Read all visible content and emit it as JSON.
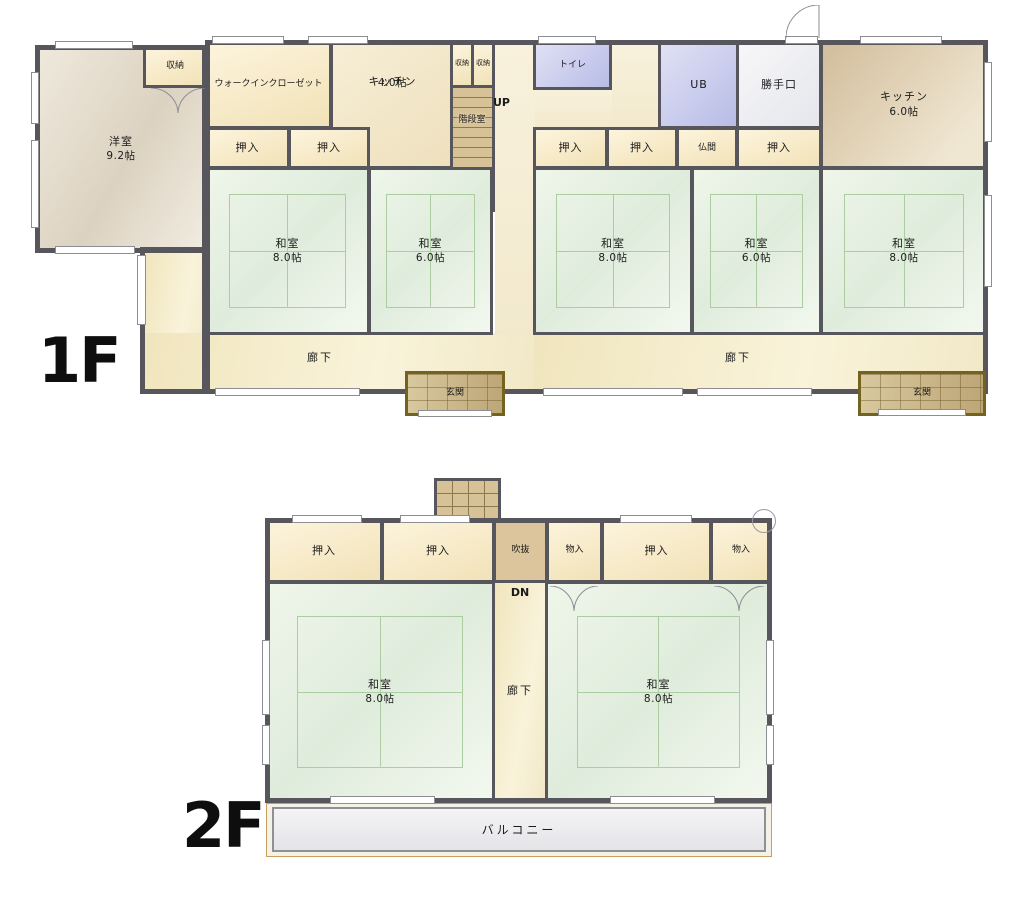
{
  "palette": {
    "wall": "#56565c",
    "label": "#1b1b1b",
    "tatami-line": "#accda2",
    "tatami-fill": "#e9f2e5",
    "closet-fill": "#f7ecce",
    "blue-room": "#c6c9ec",
    "kitchen-tan": "#d8c4a3",
    "hall-fill": "#f4ebc8",
    "genkan-fill": "#c9b183",
    "genkan-frame": "#73631f",
    "stairs-fill": "#d7c197",
    "balcony-fill": "#ececef"
  },
  "floors": {
    "f1": {
      "floor_label": "1F",
      "up_label": "UP",
      "rooms": {
        "yoshitsu": {
          "name": "洋室",
          "size": "9.2帖"
        },
        "shuno_top": {
          "name": "収納"
        },
        "wic": {
          "name": "ウォークインクローゼット"
        },
        "kitchen4": {
          "name": "キッチン",
          "size": "4.0帖"
        },
        "shuno_a": {
          "name": "収納"
        },
        "shuno_b": {
          "name": "収納"
        },
        "kaidan": {
          "name": "階段室"
        },
        "toilet": {
          "name": "トイレ"
        },
        "ub": {
          "name": "UB"
        },
        "katteguchi": {
          "name": "勝手口"
        },
        "kitchen6": {
          "name": "キッチン",
          "size": "6.0帖"
        },
        "oshiire_l1": {
          "name": "押入"
        },
        "oshiire_l2": {
          "name": "押入"
        },
        "oshiire_r1": {
          "name": "押入"
        },
        "oshiire_r2": {
          "name": "押入"
        },
        "butsuma": {
          "name": "仏間"
        },
        "oshiire_r3": {
          "name": "押入"
        },
        "washitsu_l1": {
          "name": "和室",
          "size": "8.0帖"
        },
        "washitsu_l2": {
          "name": "和室",
          "size": "6.0帖"
        },
        "washitsu_r1": {
          "name": "和室",
          "size": "8.0帖"
        },
        "washitsu_r2": {
          "name": "和室",
          "size": "6.0帖"
        },
        "washitsu_r3": {
          "name": "和室",
          "size": "8.0帖"
        },
        "rouka_l": {
          "name": "廊下"
        },
        "rouka_r": {
          "name": "廊下"
        },
        "genkan_l": {
          "name": "玄関"
        },
        "genkan_r": {
          "name": "玄関"
        }
      }
    },
    "f2": {
      "floor_label": "2F",
      "dn_label": "DN",
      "rooms": {
        "oshiire_1": {
          "name": "押入"
        },
        "oshiire_2": {
          "name": "押入"
        },
        "fukinuke": {
          "name": "吹抜"
        },
        "monoire_1": {
          "name": "物入"
        },
        "oshiire_3": {
          "name": "押入"
        },
        "monoire_2": {
          "name": "物入"
        },
        "washitsu_1": {
          "name": "和室",
          "size": "8.0帖"
        },
        "washitsu_2": {
          "name": "和室",
          "size": "8.0帖"
        },
        "rouka": {
          "name": "廊下"
        },
        "balcony": {
          "name": "バルコニー"
        }
      }
    }
  }
}
